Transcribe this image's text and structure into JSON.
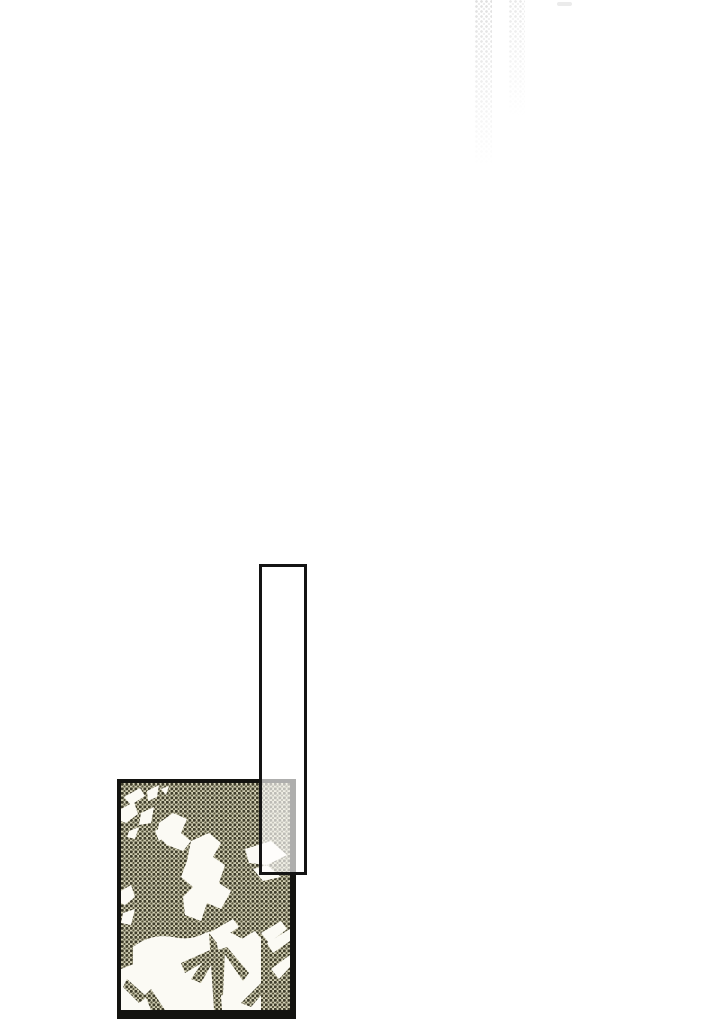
{
  "page": {
    "kind": "webtoon-comic-scroll-segment",
    "background_color": "#ffffff",
    "visible_text": ""
  },
  "top_fade": {
    "strip_count": 2,
    "dot_color_strong": "#e0e0e0",
    "dot_color_light": "#ececec",
    "speck_color": "#ebebeb"
  },
  "empty_frame": {
    "border_color": "#141414",
    "fill": "rgba(255,255,255,0.66)",
    "fill_opacity": 0.66
  },
  "leaf_panel": {
    "border_color": "#131310",
    "description": "halftone screentone of tree foliage with white leaf silhouettes"
  },
  "colors": {
    "tone_base": "#d2cfb4",
    "tone_dot_dark": "#3e3c2a",
    "tone_dot_mid": "#57543c",
    "leaf_white": "#fbfaf4",
    "panel_border": "#131310",
    "frame_border": "#141414"
  }
}
